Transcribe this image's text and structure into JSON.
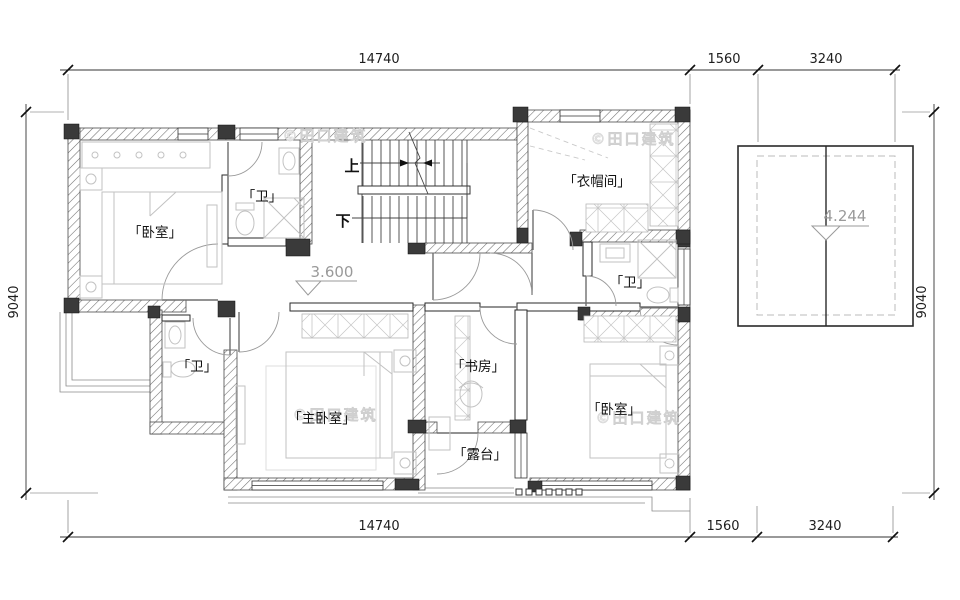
{
  "title": "second-floor-plan",
  "watermark": {
    "text": "©田口建筑"
  },
  "dimensions": {
    "top": {
      "d1": "14740",
      "d2": "1560",
      "d3": "3240"
    },
    "bottom": {
      "d1": "14740",
      "d2": "1560",
      "d3": "3240"
    },
    "left": "9040",
    "right": "9040"
  },
  "rooms": {
    "bedroom_top_left": "「卧室」",
    "bath_top": "「卫」",
    "cloakroom": "「衣帽间」",
    "bath_right": "「卫」",
    "bath_left": "「卫」",
    "master_bedroom": "「主卧室」",
    "study": "「书房」",
    "terrace": "「露台」",
    "bedroom_bottom_right": "「卧室」"
  },
  "stairs": {
    "up": "上",
    "down": "下"
  },
  "elevations": {
    "floor": "3.600",
    "roof": "4.244"
  },
  "colors": {
    "background": "#ffffff",
    "wall_hatch": "#6e6e6e",
    "column": "#3a3a3a",
    "line": "#333333",
    "furniture": "#c2c2c2",
    "label": "#111111",
    "elevation": "#9a9a9a",
    "watermark": "#e0e0e0"
  }
}
